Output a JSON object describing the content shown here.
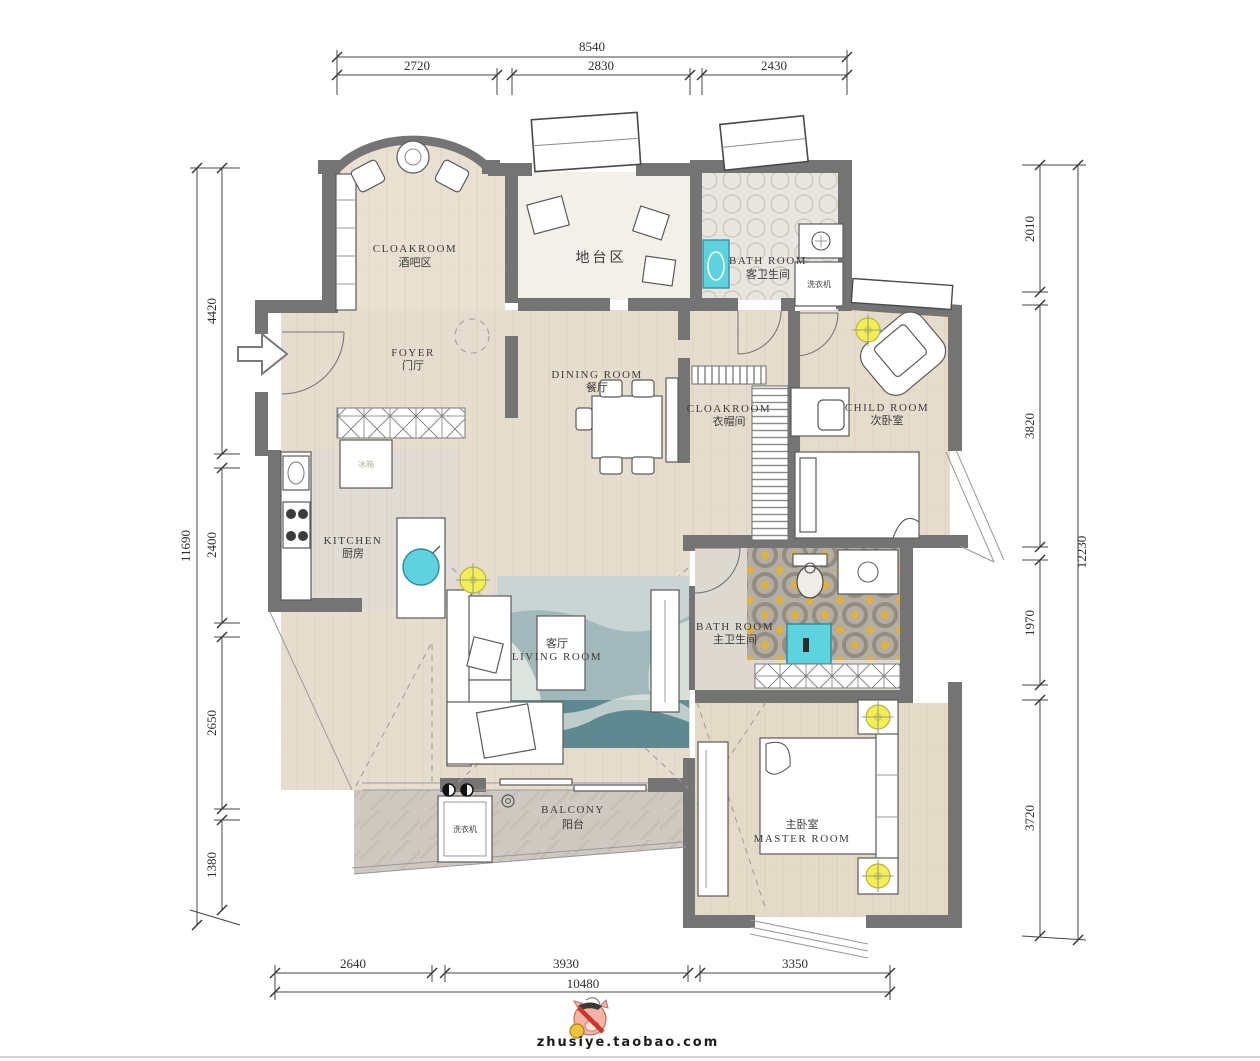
{
  "watermark": {
    "site": "zhusiye.taobao.com"
  },
  "dims": {
    "top": {
      "total": "8540",
      "segments": [
        "2720",
        "2830",
        "2430"
      ]
    },
    "left": {
      "total": "11690",
      "segments": [
        "4420",
        "2400",
        "2650",
        "1380"
      ]
    },
    "right": {
      "total": "12230",
      "segments": [
        "2010",
        "3820",
        "1970",
        "3720"
      ]
    },
    "bottom": {
      "total": "10480",
      "segments": [
        "2640",
        "3930",
        "3350"
      ]
    }
  },
  "rooms": {
    "bar": {
      "en": "CLOAKROOM",
      "zh": "酒吧区"
    },
    "platform": {
      "zh": "地台区"
    },
    "guest_bath": {
      "en": "BATH ROOM",
      "zh": "客卫生间"
    },
    "guest_bath_washer": {
      "zh": "洗衣机"
    },
    "foyer": {
      "en": "FOYER",
      "zh": "门厅"
    },
    "dining": {
      "en": "DINING ROOM",
      "zh": "餐厅"
    },
    "cloakroom": {
      "en": "CLOAKROOM",
      "zh": "衣帽间"
    },
    "child": {
      "en": "CHILD ROOM",
      "zh": "次卧室"
    },
    "kitchen": {
      "en": "KITCHEN",
      "zh": "厨房"
    },
    "master_bath": {
      "en": "BATH ROOM",
      "zh": "主卫生间"
    },
    "living": {
      "en": "LIVING ROOM",
      "zh": "客厅"
    },
    "balcony": {
      "en": "BALCONY",
      "zh": "阳台"
    },
    "balcony_washer": {
      "zh": "洗衣机"
    },
    "master": {
      "en": "MASTER ROOM",
      "zh": "主卧室"
    },
    "fridge": {
      "zh": "冰箱"
    }
  },
  "colors": {
    "wall": "#747474",
    "wood_floor": "#e7ddcf",
    "tile_floor": "#cfc9c1",
    "bath_tile": "#b3ada3",
    "accent_cyan": "#5ed2de",
    "accent_yellow": "#f2ef55",
    "rug_teal": "#a2b9bc",
    "rug_dark_teal": "#53808a"
  }
}
